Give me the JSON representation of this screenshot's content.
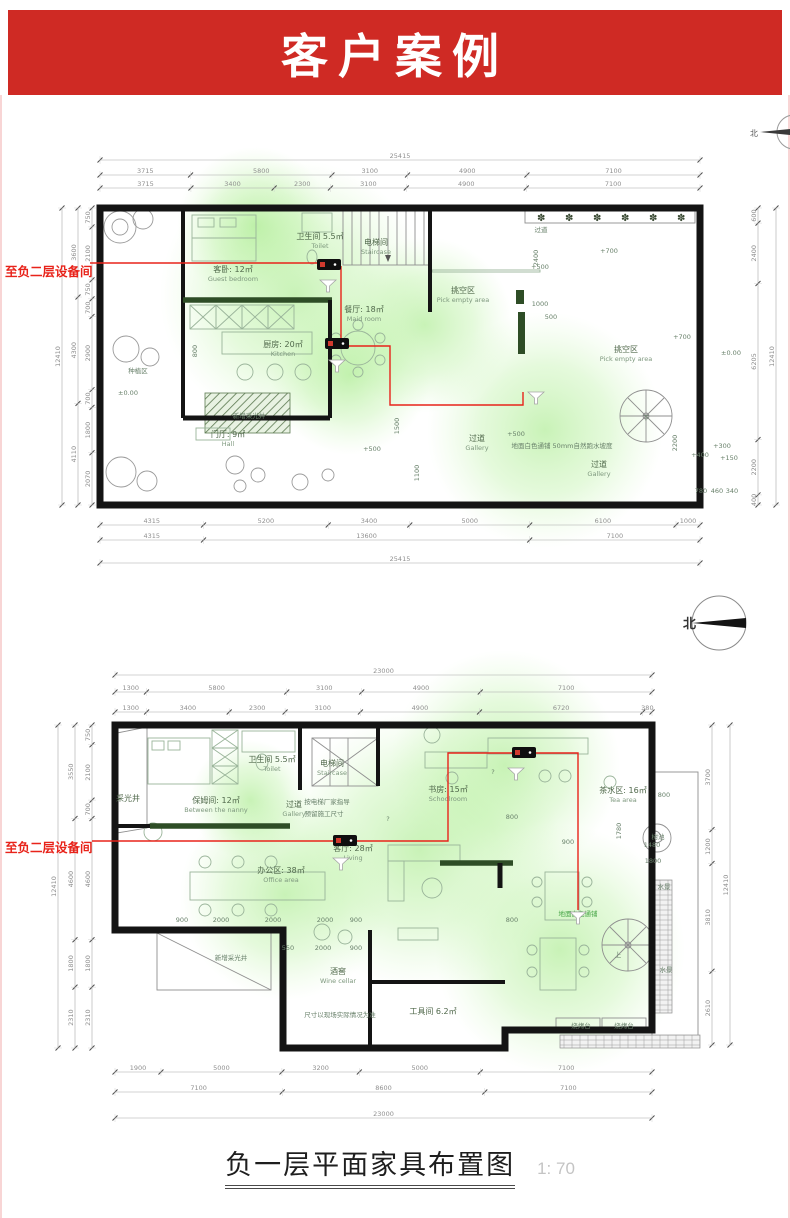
{
  "banner": {
    "title": "客户案例",
    "bg": "#cf2a24",
    "fg": "#ffffff"
  },
  "title_block": {
    "title": "负一层平面家具布置图",
    "scale": "1: 70"
  },
  "compass": {
    "north": "北"
  },
  "plans": {
    "plan1": {
      "equipment_label": "至负二层设备间",
      "dims": {
        "top_rows": [
          [
            "25415"
          ],
          [
            "3715",
            "5800",
            "3100",
            "4900",
            "7100"
          ],
          [
            "3715",
            "3400",
            "2300",
            "3100",
            "4900",
            "7100"
          ]
        ],
        "bottom_rows": [
          [
            "4315",
            "5200",
            "3400",
            "5000",
            "6100",
            "1000"
          ],
          [
            "4315",
            "13600",
            "7100"
          ],
          [
            "25415"
          ]
        ],
        "left_cols": [
          [
            "750",
            "2100",
            "750",
            "700",
            "2900",
            "700",
            "1800",
            "2070"
          ],
          [
            "3600",
            "4300",
            "4110"
          ],
          [
            "12410"
          ]
        ],
        "right_cols": [
          [
            "600",
            "2400",
            "6205",
            "2200",
            "400"
          ],
          [
            "12410"
          ]
        ]
      },
      "rooms": [
        {
          "zh": "客卧: 12㎡",
          "en": "Guest bedroom",
          "x": 233,
          "y": 152
        },
        {
          "zh": "卫生间 5.5㎡",
          "en": "Toilet",
          "x": 320,
          "y": 119
        },
        {
          "zh": "电梯间",
          "en": "Staircase",
          "x": 376,
          "y": 125
        },
        {
          "zh": "餐厅: 18㎡",
          "en": "Maid room",
          "x": 364,
          "y": 192
        },
        {
          "zh": "厨房: 20㎡",
          "en": "Kitchen",
          "x": 283,
          "y": 227
        },
        {
          "zh": "挑空区",
          "en": "Pick empty area",
          "x": 463,
          "y": 173
        },
        {
          "zh": "挑空区",
          "en": "Pick empty area",
          "x": 626,
          "y": 232
        },
        {
          "zh": "门厅: 9㎡",
          "en": "Hall",
          "x": 228,
          "y": 317
        },
        {
          "zh": "过道",
          "en": "Gallery",
          "x": 477,
          "y": 321
        },
        {
          "zh": "过道",
          "en": "Gallery",
          "x": 599,
          "y": 347
        }
      ],
      "labels": [
        {
          "t": "过道",
          "x": 541,
          "y": 112
        },
        {
          "t": "种植区",
          "x": 138,
          "y": 253
        },
        {
          "t": "新增采光井",
          "x": 249,
          "y": 298
        },
        {
          "t": "地面白色通铺 50mm自然跑水坡度",
          "x": 562,
          "y": 328
        },
        {
          "t": "下",
          "x": 646,
          "y": 300
        },
        {
          "t": "±0.00",
          "x": 128,
          "y": 275
        },
        {
          "t": "+700",
          "x": 609,
          "y": 133
        },
        {
          "t": "+500",
          "x": 540,
          "y": 149
        },
        {
          "t": "+700",
          "x": 682,
          "y": 219
        },
        {
          "t": "±0.00",
          "x": 731,
          "y": 235
        },
        {
          "t": "+500",
          "x": 372,
          "y": 331
        },
        {
          "t": "+500",
          "x": 516,
          "y": 316
        },
        {
          "t": "+400",
          "x": 700,
          "y": 337
        },
        {
          "t": "+300",
          "x": 722,
          "y": 328
        },
        {
          "t": "+150",
          "x": 729,
          "y": 340
        },
        {
          "t": "1000",
          "x": 540,
          "y": 186
        },
        {
          "t": "500",
          "x": 551,
          "y": 199
        },
        {
          "t": "2400",
          "x": 538,
          "y": 138,
          "rot": -90
        },
        {
          "t": "1500",
          "x": 399,
          "y": 306,
          "rot": -90
        },
        {
          "t": "1100",
          "x": 419,
          "y": 353,
          "rot": -90
        },
        {
          "t": "2200",
          "x": 677,
          "y": 323,
          "rot": -90
        },
        {
          "t": "800",
          "x": 197,
          "y": 231,
          "rot": -90
        },
        {
          "t": "780",
          "x": 701,
          "y": 373
        },
        {
          "t": "460",
          "x": 717,
          "y": 373
        },
        {
          "t": "340",
          "x": 732,
          "y": 373
        }
      ],
      "devices": [
        {
          "x": 317,
          "y": 139
        },
        {
          "x": 325,
          "y": 218
        }
      ],
      "wires": [
        "M90,143 L317,143",
        "M341,146 L341,218",
        "M349,226 L390,226 L390,285 L523,285 L523,272"
      ],
      "funnels": [
        {
          "x": 328,
          "y": 160
        },
        {
          "x": 337,
          "y": 240
        },
        {
          "x": 536,
          "y": 272
        }
      ]
    },
    "plan2": {
      "equipment_label": "至负二层设备间",
      "dims": {
        "top_rows": [
          [
            "23000"
          ],
          [
            "1300",
            "5800",
            "3100",
            "4900",
            "7100"
          ],
          [
            "1300",
            "3400",
            "2300",
            "3100",
            "4900",
            "6720",
            "380"
          ]
        ],
        "bottom_rows": [
          [
            "1900",
            "5000",
            "3200",
            "5000",
            "7100"
          ],
          [
            "7100",
            "8600",
            "7100"
          ],
          [
            "23000"
          ]
        ],
        "left_cols": [
          [
            "750",
            "2100",
            "700",
            "4600",
            "1800",
            "2310"
          ],
          [
            "3550",
            "4600",
            "1800",
            "2310"
          ],
          [
            "12410"
          ]
        ],
        "right_cols": [
          [
            "3700",
            "1200",
            "3810",
            "2610"
          ],
          [
            "12410"
          ]
        ]
      },
      "rooms": [
        {
          "zh": "保姆间: 12㎡",
          "en": "Between the nanny",
          "x": 216,
          "y": 203
        },
        {
          "zh": "采光井",
          "en": "",
          "x": 128,
          "y": 201
        },
        {
          "zh": "卫生间 5.5㎡",
          "en": "Toilet",
          "x": 272,
          "y": 162
        },
        {
          "zh": "电梯间",
          "en": "Staircase",
          "x": 332,
          "y": 166
        },
        {
          "zh": "过道",
          "en": "Gallery",
          "x": 294,
          "y": 207
        },
        {
          "zh": "办公区: 38㎡",
          "en": "Office area",
          "x": 281,
          "y": 273
        },
        {
          "zh": "客厅: 28㎡",
          "en": "Living",
          "x": 353,
          "y": 251
        },
        {
          "zh": "书房: 15㎡",
          "en": "Schoolroom",
          "x": 448,
          "y": 192
        },
        {
          "zh": "茶水区: 16㎡",
          "en": "Tea area",
          "x": 623,
          "y": 193
        },
        {
          "zh": "酒窖",
          "en": "Wine cellar",
          "x": 338,
          "y": 374
        },
        {
          "zh": "工具间 6.2㎡",
          "en": "",
          "x": 433,
          "y": 414
        }
      ],
      "labels": [
        {
          "t": "按电梯厂家指导",
          "x": 327,
          "y": 204
        },
        {
          "t": "预留施工尺寸",
          "x": 324,
          "y": 216
        },
        {
          "t": "新增采光井",
          "x": 231,
          "y": 360
        },
        {
          "t": "尺寸以现场实际情况为准",
          "x": 340,
          "y": 417
        },
        {
          "t": "烧烤台",
          "x": 581,
          "y": 428
        },
        {
          "t": "烧烤台",
          "x": 624,
          "y": 428
        },
        {
          "t": "水景",
          "x": 664,
          "y": 289
        },
        {
          "t": "水景",
          "x": 666,
          "y": 372
        },
        {
          "t": "树池",
          "x": 658,
          "y": 239
        },
        {
          "t": "1480",
          "x": 652,
          "y": 247
        },
        {
          "t": "1800",
          "x": 653,
          "y": 263
        },
        {
          "t": "1780",
          "x": 621,
          "y": 231,
          "rot": -90
        },
        {
          "t": "地面白色通铺",
          "x": 578,
          "y": 316,
          "c": "#46a546"
        },
        {
          "t": "上",
          "x": 618,
          "y": 357
        },
        {
          "t": "900",
          "x": 182,
          "y": 322
        },
        {
          "t": "2000",
          "x": 221,
          "y": 322
        },
        {
          "t": "2000",
          "x": 273,
          "y": 322
        },
        {
          "t": "2000",
          "x": 325,
          "y": 322
        },
        {
          "t": "900",
          "x": 356,
          "y": 322
        },
        {
          "t": "550",
          "x": 288,
          "y": 350
        },
        {
          "t": "2000",
          "x": 323,
          "y": 350
        },
        {
          "t": "900",
          "x": 356,
          "y": 350
        },
        {
          "t": "800",
          "x": 512,
          "y": 219
        },
        {
          "t": "800",
          "x": 664,
          "y": 197
        },
        {
          "t": "900",
          "x": 568,
          "y": 244
        },
        {
          "t": "800",
          "x": 512,
          "y": 322
        },
        {
          "t": "?",
          "x": 493,
          "y": 174
        },
        {
          "t": "?",
          "x": 388,
          "y": 221
        }
      ],
      "devices": [
        {
          "x": 333,
          "y": 235
        },
        {
          "x": 512,
          "y": 147
        }
      ],
      "wires": [
        "M92,241 L333,241",
        "M357,241 L448,241 L448,153 L512,153",
        "M536,153 L578,153 L578,310"
      ],
      "funnels": [
        {
          "x": 341,
          "y": 258
        },
        {
          "x": 516,
          "y": 168
        },
        {
          "x": 578,
          "y": 312
        }
      ]
    }
  }
}
